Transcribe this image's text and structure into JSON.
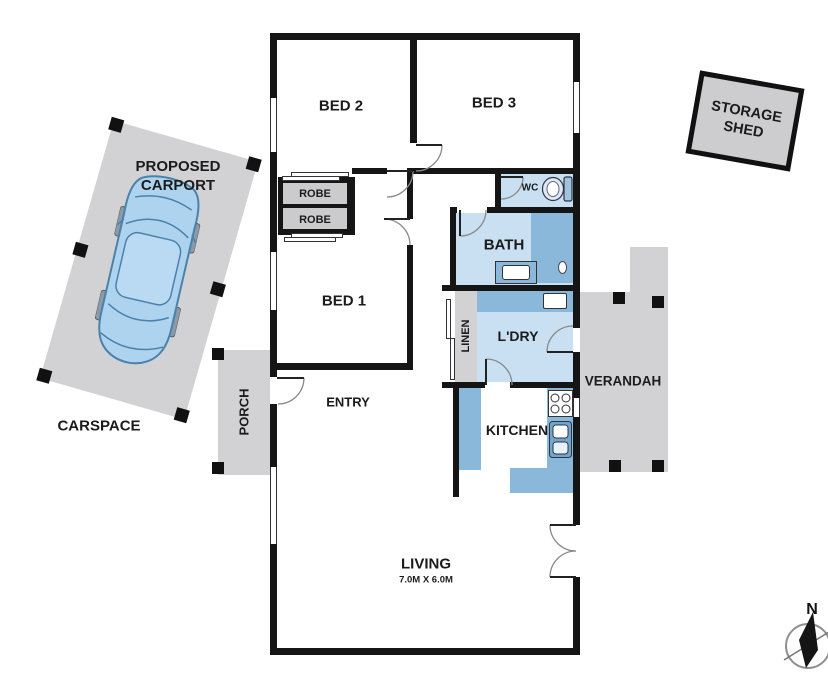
{
  "plan_title": "3 bedroom house floor plan",
  "rooms": {
    "bed2": "BED 2",
    "bed3": "BED 3",
    "bed1": "BED 1",
    "robe1": "ROBE",
    "robe2": "ROBE",
    "wc": "WC",
    "bath": "BATH",
    "linen": "LINEN",
    "laundry": "L'DRY",
    "kitchen": "KITCHEN",
    "entry": "ENTRY",
    "porch": "PORCH",
    "living": "LIVING",
    "living_dims": "7.0M X 6.0M",
    "verandah": "VERANDAH"
  },
  "outdoor": {
    "carport_line1": "PROPOSED",
    "carport_line2": "CARPORT",
    "carspace": "CARSPACE",
    "shed_line1": "STORAGE",
    "shed_line2": "SHED"
  },
  "compass": {
    "north": "N"
  },
  "colors": {
    "wall": "#151515",
    "outdoor_gray": "#d2d2d4",
    "wet_area_light_blue": "#c9e0f2",
    "fixture_blue": "#8ab8da",
    "car_blue": "#aed3ee"
  }
}
